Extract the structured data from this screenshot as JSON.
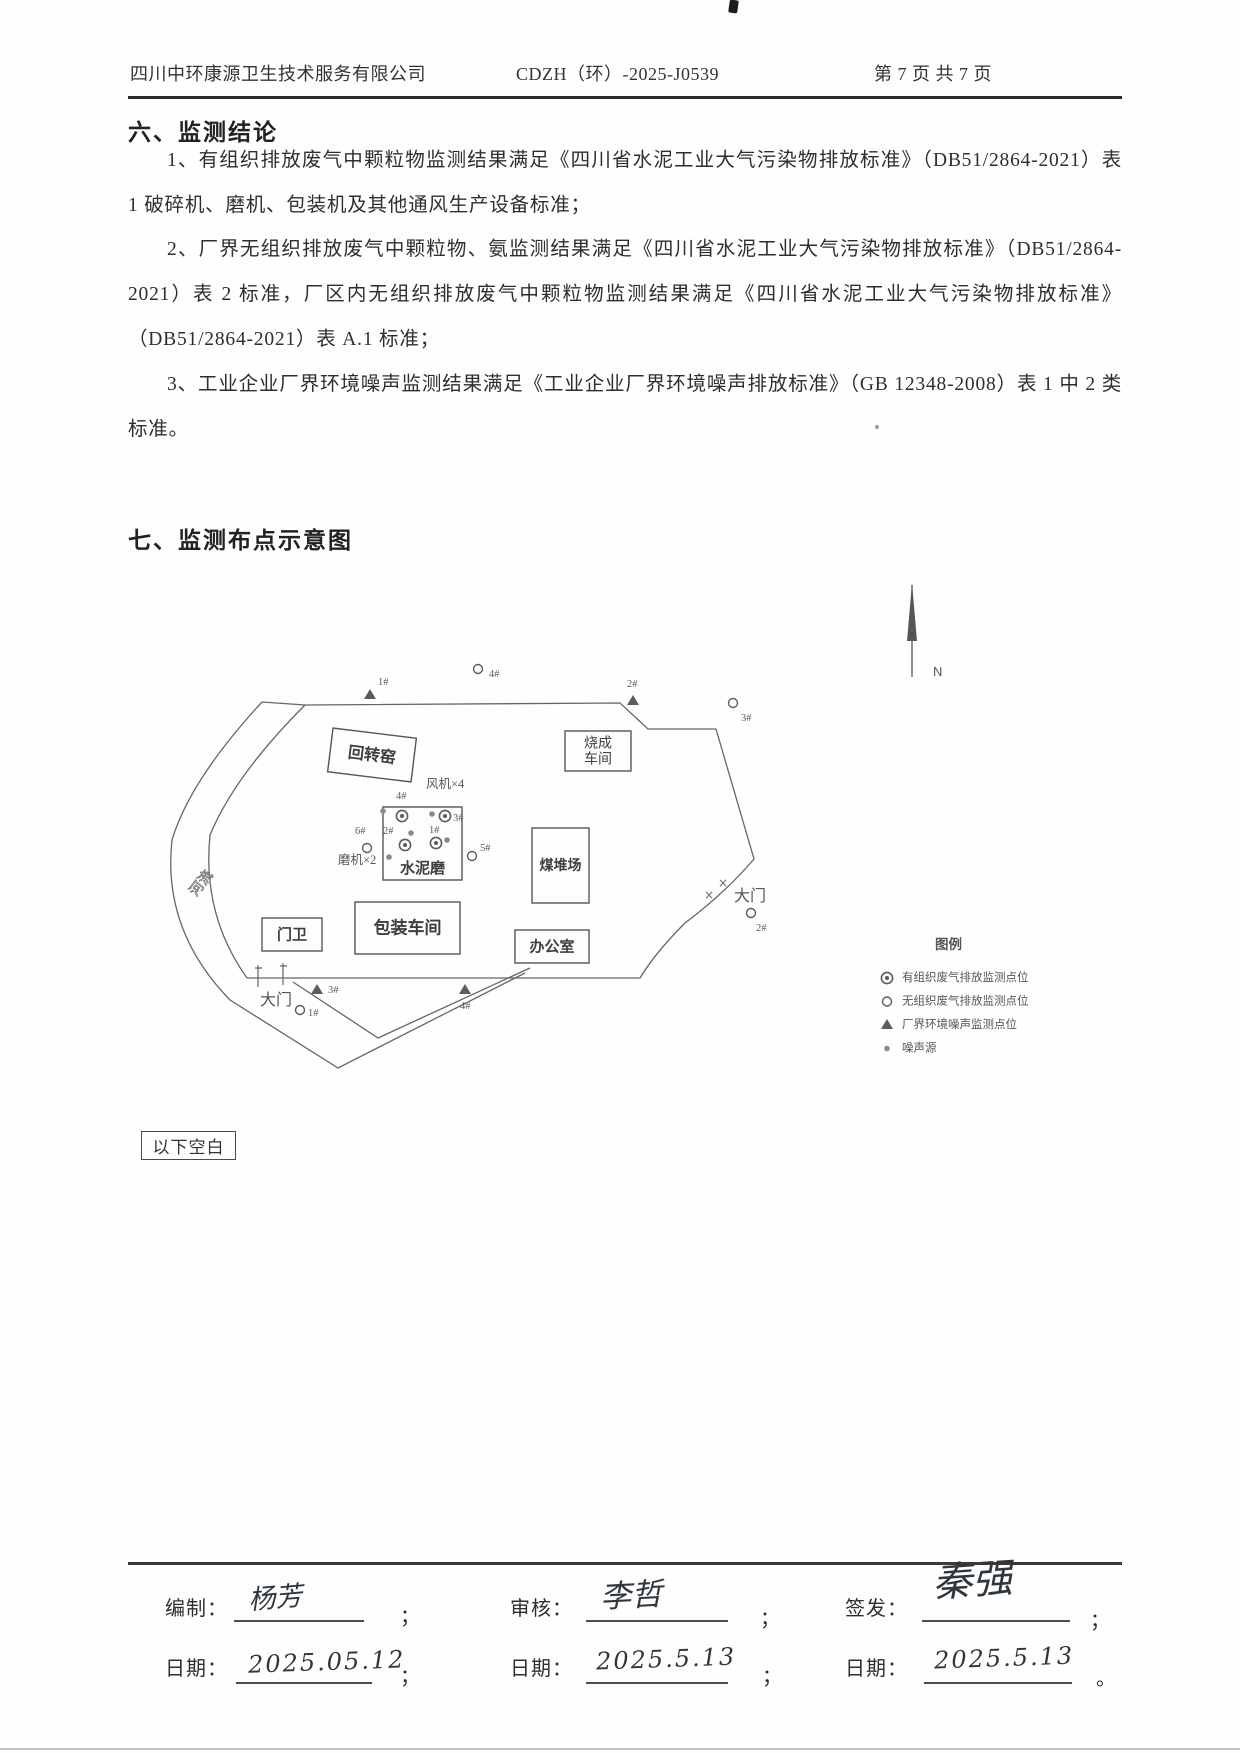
{
  "header": {
    "company": "四川中环康源卫生技术服务有限公司",
    "doc_no": "CDZH（环）-2025-J0539",
    "page_info": "第 7 页 共 7 页"
  },
  "section6": {
    "title": "六、监测结论",
    "paragraphs": [
      "1、有组织排放废气中颗粒物监测结果满足《四川省水泥工业大气污染物排放标准》（DB51/2864-2021）表 1 破碎机、磨机、包装机及其他通风生产设备标准；",
      "2、厂界无组织排放废气中颗粒物、氨监测结果满足《四川省水泥工业大气污染物排放标准》（DB51/2864-2021）表 2 标准，厂区内无组织排放废气中颗粒物监测结果满足《四川省水泥工业大气污染物排放标准》（DB51/2864-2021）表 A.1 标准；",
      "3、工业企业厂界环境噪声监测结果满足《工业企业厂界环境噪声排放标准》（GB 12348-2008）表 1 中 2 类标准。"
    ]
  },
  "section7": {
    "title": "七、监测布点示意图"
  },
  "diagram": {
    "north_label": "N",
    "buildings": [
      {
        "name": "rotary-kiln",
        "label": "回转窑",
        "x": 180,
        "y": 198,
        "w": 84,
        "h": 44,
        "rot": 7,
        "fs": 16
      },
      {
        "name": "firing-workshop",
        "label_lines": [
          "烧成",
          "车间"
        ],
        "x": 415,
        "y": 196,
        "w": 66,
        "h": 40,
        "fs": 14
      },
      {
        "name": "cement-mill",
        "label": "水泥磨",
        "x": 233,
        "y": 272,
        "w": 79,
        "h": 73,
        "fs": 15,
        "ly": 338
      },
      {
        "name": "coal-yard",
        "label": "煤堆场",
        "x": 382,
        "y": 293,
        "w": 57,
        "h": 75,
        "fs": 14
      },
      {
        "name": "gate-house",
        "label": "门卫",
        "x": 112,
        "y": 383,
        "w": 60,
        "h": 33,
        "fs": 15
      },
      {
        "name": "packing-workshop",
        "label": "包装车间",
        "x": 205,
        "y": 367,
        "w": 105,
        "h": 52,
        "fs": 17
      },
      {
        "name": "office",
        "label": "办公室",
        "x": 365,
        "y": 395,
        "w": 74,
        "h": 33,
        "fs": 15
      }
    ],
    "texts": [
      {
        "name": "fan-count-label",
        "label": "风机×4",
        "x": 276,
        "y": 253,
        "fs": 12.5
      },
      {
        "name": "mill-count-label",
        "label": "磨机×2",
        "x": 188,
        "y": 329,
        "fs": 12.5
      },
      {
        "name": "river-label",
        "label": "河流",
        "x": 0,
        "y": 0,
        "fs": 14,
        "tr": "translate(46,362) rotate(-52)",
        "hollow": true
      },
      {
        "name": "gate-left-label",
        "label": "大门",
        "x": 110,
        "y": 470,
        "fs": 16
      },
      {
        "name": "gate-right-label",
        "label": "大门",
        "x": 584,
        "y": 366,
        "fs": 16
      },
      {
        "name": "legend-title",
        "label": "图例",
        "x": 785,
        "y": 414,
        "fs": 13.5,
        "bold": true
      }
    ],
    "markers": [
      {
        "t": "tri",
        "x": 220,
        "y": 160,
        "label": "1#",
        "lx": 228,
        "ly": 150
      },
      {
        "t": "circ",
        "x": 328,
        "y": 134,
        "label": "4#",
        "lx": 339,
        "ly": 142
      },
      {
        "t": "tri",
        "x": 483,
        "y": 166,
        "label": "2#",
        "lx": 477,
        "ly": 152
      },
      {
        "t": "circ",
        "x": 583,
        "y": 168,
        "label": "3#",
        "lx": 591,
        "ly": 186
      },
      {
        "t": "circ",
        "x": 601,
        "y": 378,
        "label": "2#",
        "lx": 606,
        "ly": 396
      },
      {
        "t": "tri",
        "x": 167,
        "y": 455,
        "label": "3#",
        "lx": 178,
        "ly": 458
      },
      {
        "t": "circ",
        "x": 150,
        "y": 475,
        "label": "1#",
        "lx": 158,
        "ly": 481
      },
      {
        "t": "tri",
        "x": 315,
        "y": 455,
        "label": "4#",
        "lx": 310,
        "ly": 474
      },
      {
        "t": "dot",
        "x": 233,
        "y": 276
      },
      {
        "t": "dbl",
        "x": 252,
        "y": 281,
        "label": "4#",
        "lx": 246,
        "ly": 264
      },
      {
        "t": "dot",
        "x": 282,
        "y": 279
      },
      {
        "t": "dbl",
        "x": 295,
        "y": 281,
        "label": "3#",
        "lx": 303,
        "ly": 286
      },
      {
        "t": "circ",
        "x": 217,
        "y": 313,
        "label": "6#",
        "lx": 205,
        "ly": 299
      },
      {
        "t": "dot",
        "x": 261,
        "y": 298
      },
      {
        "t": "dbl",
        "x": 255,
        "y": 310,
        "label": "2#",
        "lx": 233,
        "ly": 299
      },
      {
        "t": "dbl",
        "x": 286,
        "y": 308,
        "label": "1#",
        "lx": 279,
        "ly": 298
      },
      {
        "t": "dot",
        "x": 297,
        "y": 305
      },
      {
        "t": "dot",
        "x": 239,
        "y": 322
      },
      {
        "t": "circ",
        "x": 322,
        "y": 321,
        "label": "5#",
        "lx": 330,
        "ly": 316
      }
    ],
    "legend": {
      "x": 737,
      "tx": 752,
      "y0": 446,
      "dy": 23.5,
      "fs": 11.5,
      "items": [
        {
          "t": "dbl",
          "label": "有组织废气排放监测点位"
        },
        {
          "t": "circ",
          "label": "无组织废气排放监测点位"
        },
        {
          "t": "tri",
          "label": "厂界环境噪声监测点位"
        },
        {
          "t": "dot",
          "label": "噪声源"
        }
      ]
    }
  },
  "blank_note": "以下空白",
  "footer": {
    "prepared_label": "编制：",
    "prepared_signature": "杨芳",
    "reviewed_label": "审核：",
    "reviewed_signature": "李哲",
    "issued_label": "签发：",
    "issued_signature": "秦强",
    "date_label": "日期：",
    "dates": [
      "2025.05.12",
      "2025.5.13",
      "2025.5.13"
    ],
    "separators": [
      "；",
      "；",
      "；",
      "；",
      "；",
      "。"
    ]
  }
}
